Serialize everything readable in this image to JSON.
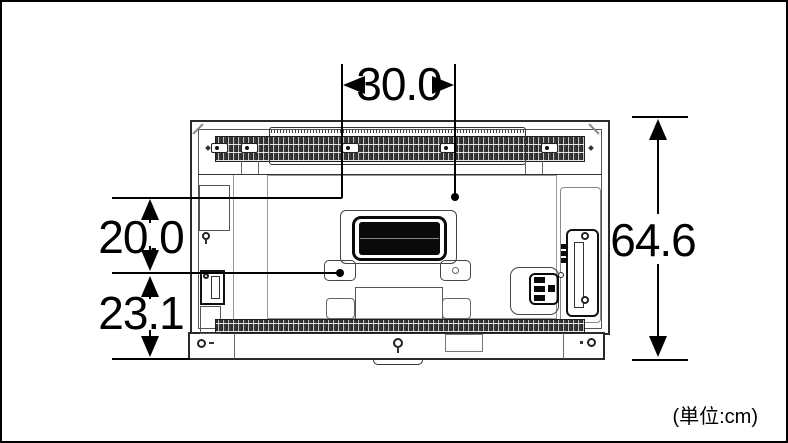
{
  "diagram": {
    "type": "tv-rear-dimension-diagram",
    "unit_note": "(単位:cm)",
    "colors": {
      "line": "#000000",
      "background": "#ffffff"
    },
    "dimensions": {
      "mount_hole_spacing_width": "30.0",
      "upper_offset_height": "20.0",
      "lower_offset_height": "23.1",
      "overall_height": "64.6"
    }
  }
}
